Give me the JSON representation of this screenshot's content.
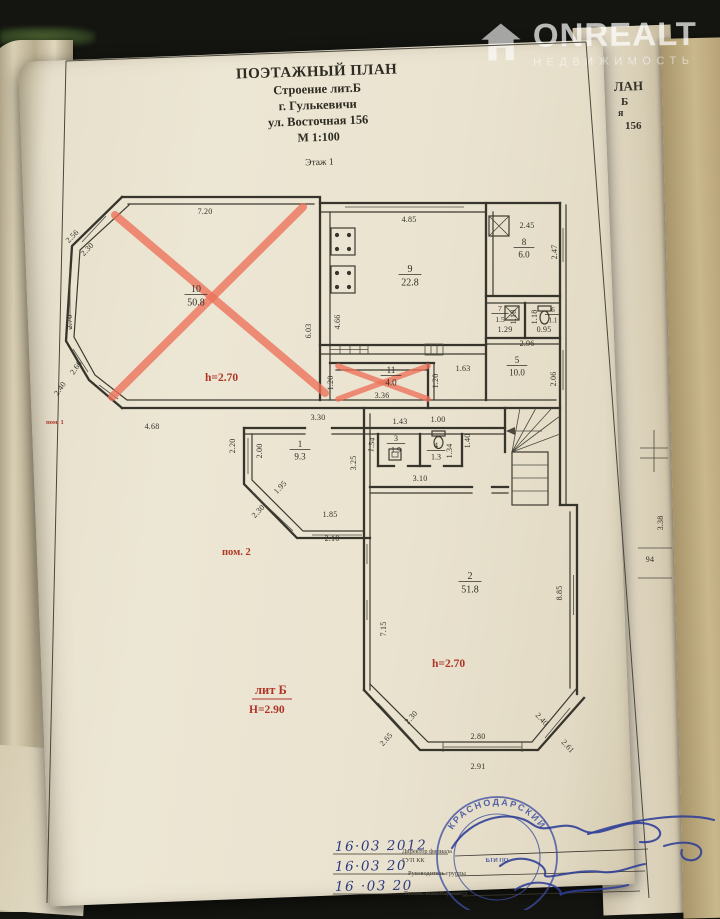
{
  "watermark": {
    "brand": "ONREALT",
    "subtitle": "НЕДВИЖИМОСТЬ"
  },
  "title_block": {
    "line1": "ПОЭТАЖНЫЙ ПЛАН",
    "line2": "Строение лит.Б",
    "line3": "г. Гулькевичи",
    "line4": "ул. Восточная 156",
    "line5": "М 1:100",
    "floor": "Этаж 1"
  },
  "plan": {
    "red": {
      "pom1": "пом. 1",
      "pom2": "пом. 2",
      "h_room10": "h=2.70",
      "h_room2": "h=2.70",
      "lit": "лит Б",
      "height_total": "Н=2.90"
    },
    "rooms": [
      {
        "n": "10",
        "a": "50.8",
        "x": 196,
        "y": 292,
        "fs": 10
      },
      {
        "n": "9",
        "a": "22.8",
        "x": 410,
        "y": 272,
        "fs": 10
      },
      {
        "n": "8",
        "a": "6.0",
        "x": 524,
        "y": 245,
        "fs": 9
      },
      {
        "n": "7",
        "a": "1.5",
        "x": 500,
        "y": 311,
        "fs": 7.5
      },
      {
        "n": "6",
        "a": "1.1",
        "x": 553,
        "y": 312,
        "fs": 7
      },
      {
        "n": "5",
        "a": "10.0",
        "x": 517,
        "y": 363,
        "fs": 9
      },
      {
        "n": "11",
        "a": "4.0",
        "x": 391,
        "y": 373,
        "fs": 9
      },
      {
        "n": "1",
        "a": "9.3",
        "x": 300,
        "y": 447,
        "fs": 9
      },
      {
        "n": "3",
        "a": "1.9",
        "x": 396,
        "y": 441,
        "fs": 8
      },
      {
        "n": "4",
        "a": "1.3",
        "x": 436,
        "y": 448,
        "fs": 8
      },
      {
        "n": "2",
        "a": "51.8",
        "x": 470,
        "y": 579,
        "fs": 10
      }
    ],
    "dims": [
      {
        "t": "7.20",
        "x": 205,
        "y": 214,
        "r": 0
      },
      {
        "t": "2.56",
        "x": 74,
        "y": 238,
        "r": -46
      },
      {
        "t": "2.30",
        "x": 89,
        "y": 251,
        "r": -46
      },
      {
        "t": "2.70",
        "x": 72,
        "y": 322,
        "r": -90
      },
      {
        "t": "2.60",
        "x": 78,
        "y": 369,
        "r": -55
      },
      {
        "t": "2.40",
        "x": 62,
        "y": 390,
        "r": -55
      },
      {
        "t": "4.68",
        "x": 152,
        "y": 429,
        "r": 0
      },
      {
        "t": "6.03",
        "x": 311,
        "y": 331,
        "r": -90
      },
      {
        "t": "4.66",
        "x": 340,
        "y": 322,
        "r": -90
      },
      {
        "t": "4.85",
        "x": 409,
        "y": 222,
        "r": 0
      },
      {
        "t": "2.45",
        "x": 527,
        "y": 228,
        "r": 0
      },
      {
        "t": "2.47",
        "x": 557,
        "y": 252,
        "r": -90
      },
      {
        "t": "1.18",
        "x": 516,
        "y": 317,
        "r": -90
      },
      {
        "t": "1.18",
        "x": 537,
        "y": 317,
        "r": -90
      },
      {
        "t": "1.29",
        "x": 505,
        "y": 332,
        "r": 0
      },
      {
        "t": "0.95",
        "x": 544,
        "y": 332,
        "r": 0
      },
      {
        "t": "2.96",
        "x": 527,
        "y": 346,
        "r": 0
      },
      {
        "t": "1.63",
        "x": 463,
        "y": 371,
        "r": 0
      },
      {
        "t": "2.06",
        "x": 556,
        "y": 379,
        "r": -90
      },
      {
        "t": "1.20",
        "x": 333,
        "y": 383,
        "r": -90
      },
      {
        "t": "1.20",
        "x": 438,
        "y": 381,
        "r": -90
      },
      {
        "t": "3.36",
        "x": 382,
        "y": 398,
        "r": 0
      },
      {
        "t": "3.30",
        "x": 318,
        "y": 420,
        "r": 0
      },
      {
        "t": "1.43",
        "x": 400,
        "y": 424,
        "r": 0
      },
      {
        "t": "1.00",
        "x": 438,
        "y": 422,
        "r": 0
      },
      {
        "t": "2.20",
        "x": 235,
        "y": 446,
        "r": -90
      },
      {
        "t": "2.00",
        "x": 262,
        "y": 451,
        "r": -90
      },
      {
        "t": "1.54",
        "x": 374,
        "y": 445,
        "r": -83
      },
      {
        "t": "1.34",
        "x": 452,
        "y": 451,
        "r": -90
      },
      {
        "t": "1.40",
        "x": 470,
        "y": 441,
        "r": -90
      },
      {
        "t": "3.25",
        "x": 356,
        "y": 463,
        "r": -90
      },
      {
        "t": "3.10",
        "x": 420,
        "y": 481,
        "r": 0
      },
      {
        "t": "1.95",
        "x": 282,
        "y": 489,
        "r": -46
      },
      {
        "t": "2.30",
        "x": 260,
        "y": 513,
        "r": -46
      },
      {
        "t": "1.85",
        "x": 330,
        "y": 517,
        "r": 0
      },
      {
        "t": "2.10",
        "x": 332,
        "y": 541,
        "r": 0
      },
      {
        "t": "7.15",
        "x": 386,
        "y": 629,
        "r": -90
      },
      {
        "t": "8.85",
        "x": 562,
        "y": 593,
        "r": -90
      },
      {
        "t": "2.30",
        "x": 413,
        "y": 719,
        "r": -48
      },
      {
        "t": "2.65",
        "x": 388,
        "y": 741,
        "r": -48
      },
      {
        "t": "2.40",
        "x": 540,
        "y": 721,
        "r": 48
      },
      {
        "t": "2.61",
        "x": 566,
        "y": 748,
        "r": 48
      },
      {
        "t": "2.80",
        "x": 478,
        "y": 739,
        "r": 0
      },
      {
        "t": "2.91",
        "x": 478,
        "y": 769,
        "r": 0
      }
    ]
  },
  "under_pages": {
    "fragments": [
      "ЛАН",
      "Б",
      "я",
      "156"
    ],
    "dims": [
      {
        "t": "3.38",
        "x": 663,
        "y": 523,
        "r": -90
      },
      {
        "t": "94",
        "x": 650,
        "y": 562,
        "r": 0
      }
    ]
  },
  "stamp_block": {
    "dates": [
      "16·03 2012",
      "16·03 20",
      "16 ·03 20"
    ],
    "titles": [
      "Директор филиала",
      "ГУП КК",
      "Руководитель группы",
      "Техник-инвентаризатор"
    ],
    "seal": {
      "top": "КРАСНОДАРСКИЙ",
      "bottom": "РАЙОНУ",
      "center": "БТИ ПО"
    }
  },
  "colors": {
    "red_annotation": "#b03526",
    "red_cross": "#ed7158",
    "seal_blue": "#3c4da0",
    "ink": "#36342b",
    "paper": "#ece6d4"
  }
}
